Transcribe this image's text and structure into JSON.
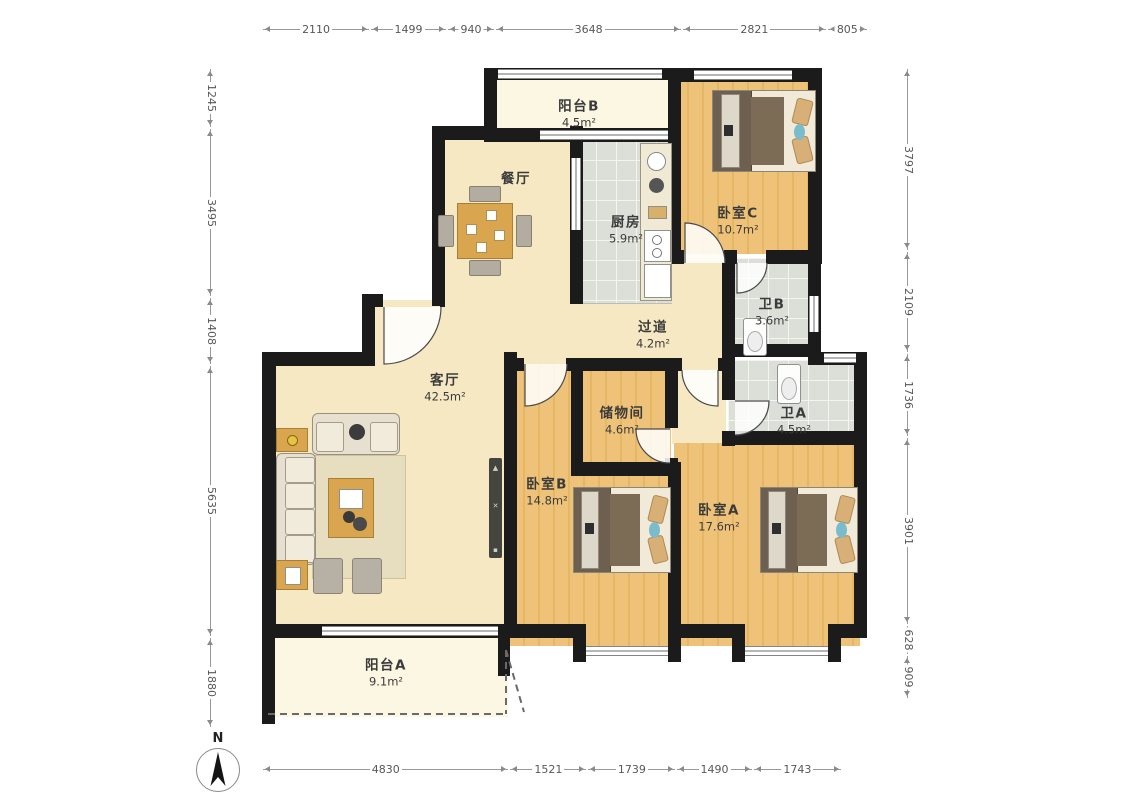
{
  "compass": {
    "label": "N"
  },
  "rooms": [
    {
      "id": "yangtai_b",
      "name": "阳台B",
      "area": "4.5m²"
    },
    {
      "id": "canting",
      "name": "餐厅",
      "area": ""
    },
    {
      "id": "chufang",
      "name": "厨房",
      "area": "5.9m²"
    },
    {
      "id": "woshi_c",
      "name": "卧室C",
      "area": "10.7m²"
    },
    {
      "id": "wei_b",
      "name": "卫B",
      "area": "3.6m²"
    },
    {
      "id": "guodao",
      "name": "过道",
      "area": "4.2m²"
    },
    {
      "id": "keting",
      "name": "客厅",
      "area": "42.5m²"
    },
    {
      "id": "chuwujian",
      "name": "储物间",
      "area": "4.6m²"
    },
    {
      "id": "wei_a",
      "name": "卫A",
      "area": "4.5m²"
    },
    {
      "id": "woshi_b",
      "name": "卧室B",
      "area": "14.8m²"
    },
    {
      "id": "woshi_a",
      "name": "卧室A",
      "area": "17.6m²"
    },
    {
      "id": "yangtai_a",
      "name": "阳台A",
      "area": "9.1m²"
    }
  ],
  "dimensions": {
    "top": [
      "2110",
      "1499",
      "940",
      "3648",
      "2821",
      "805"
    ],
    "bottom": [
      "4830",
      "1521",
      "1739",
      "1490",
      "1743"
    ],
    "left": [
      "1245",
      "3495",
      "1408",
      "5635",
      "1880"
    ],
    "right": [
      "3797",
      "2109",
      "1736",
      "3901",
      "628",
      "909"
    ]
  },
  "colors": {
    "wall": "#1b1b1b",
    "floor_cream": "#f6e8c3",
    "floor_wood": "#eec279",
    "floor_tile": "#dcded8",
    "floor_balcony": "#fbf7e3",
    "furniture_wood": "#d9a54e",
    "dimension_text": "#585858"
  }
}
